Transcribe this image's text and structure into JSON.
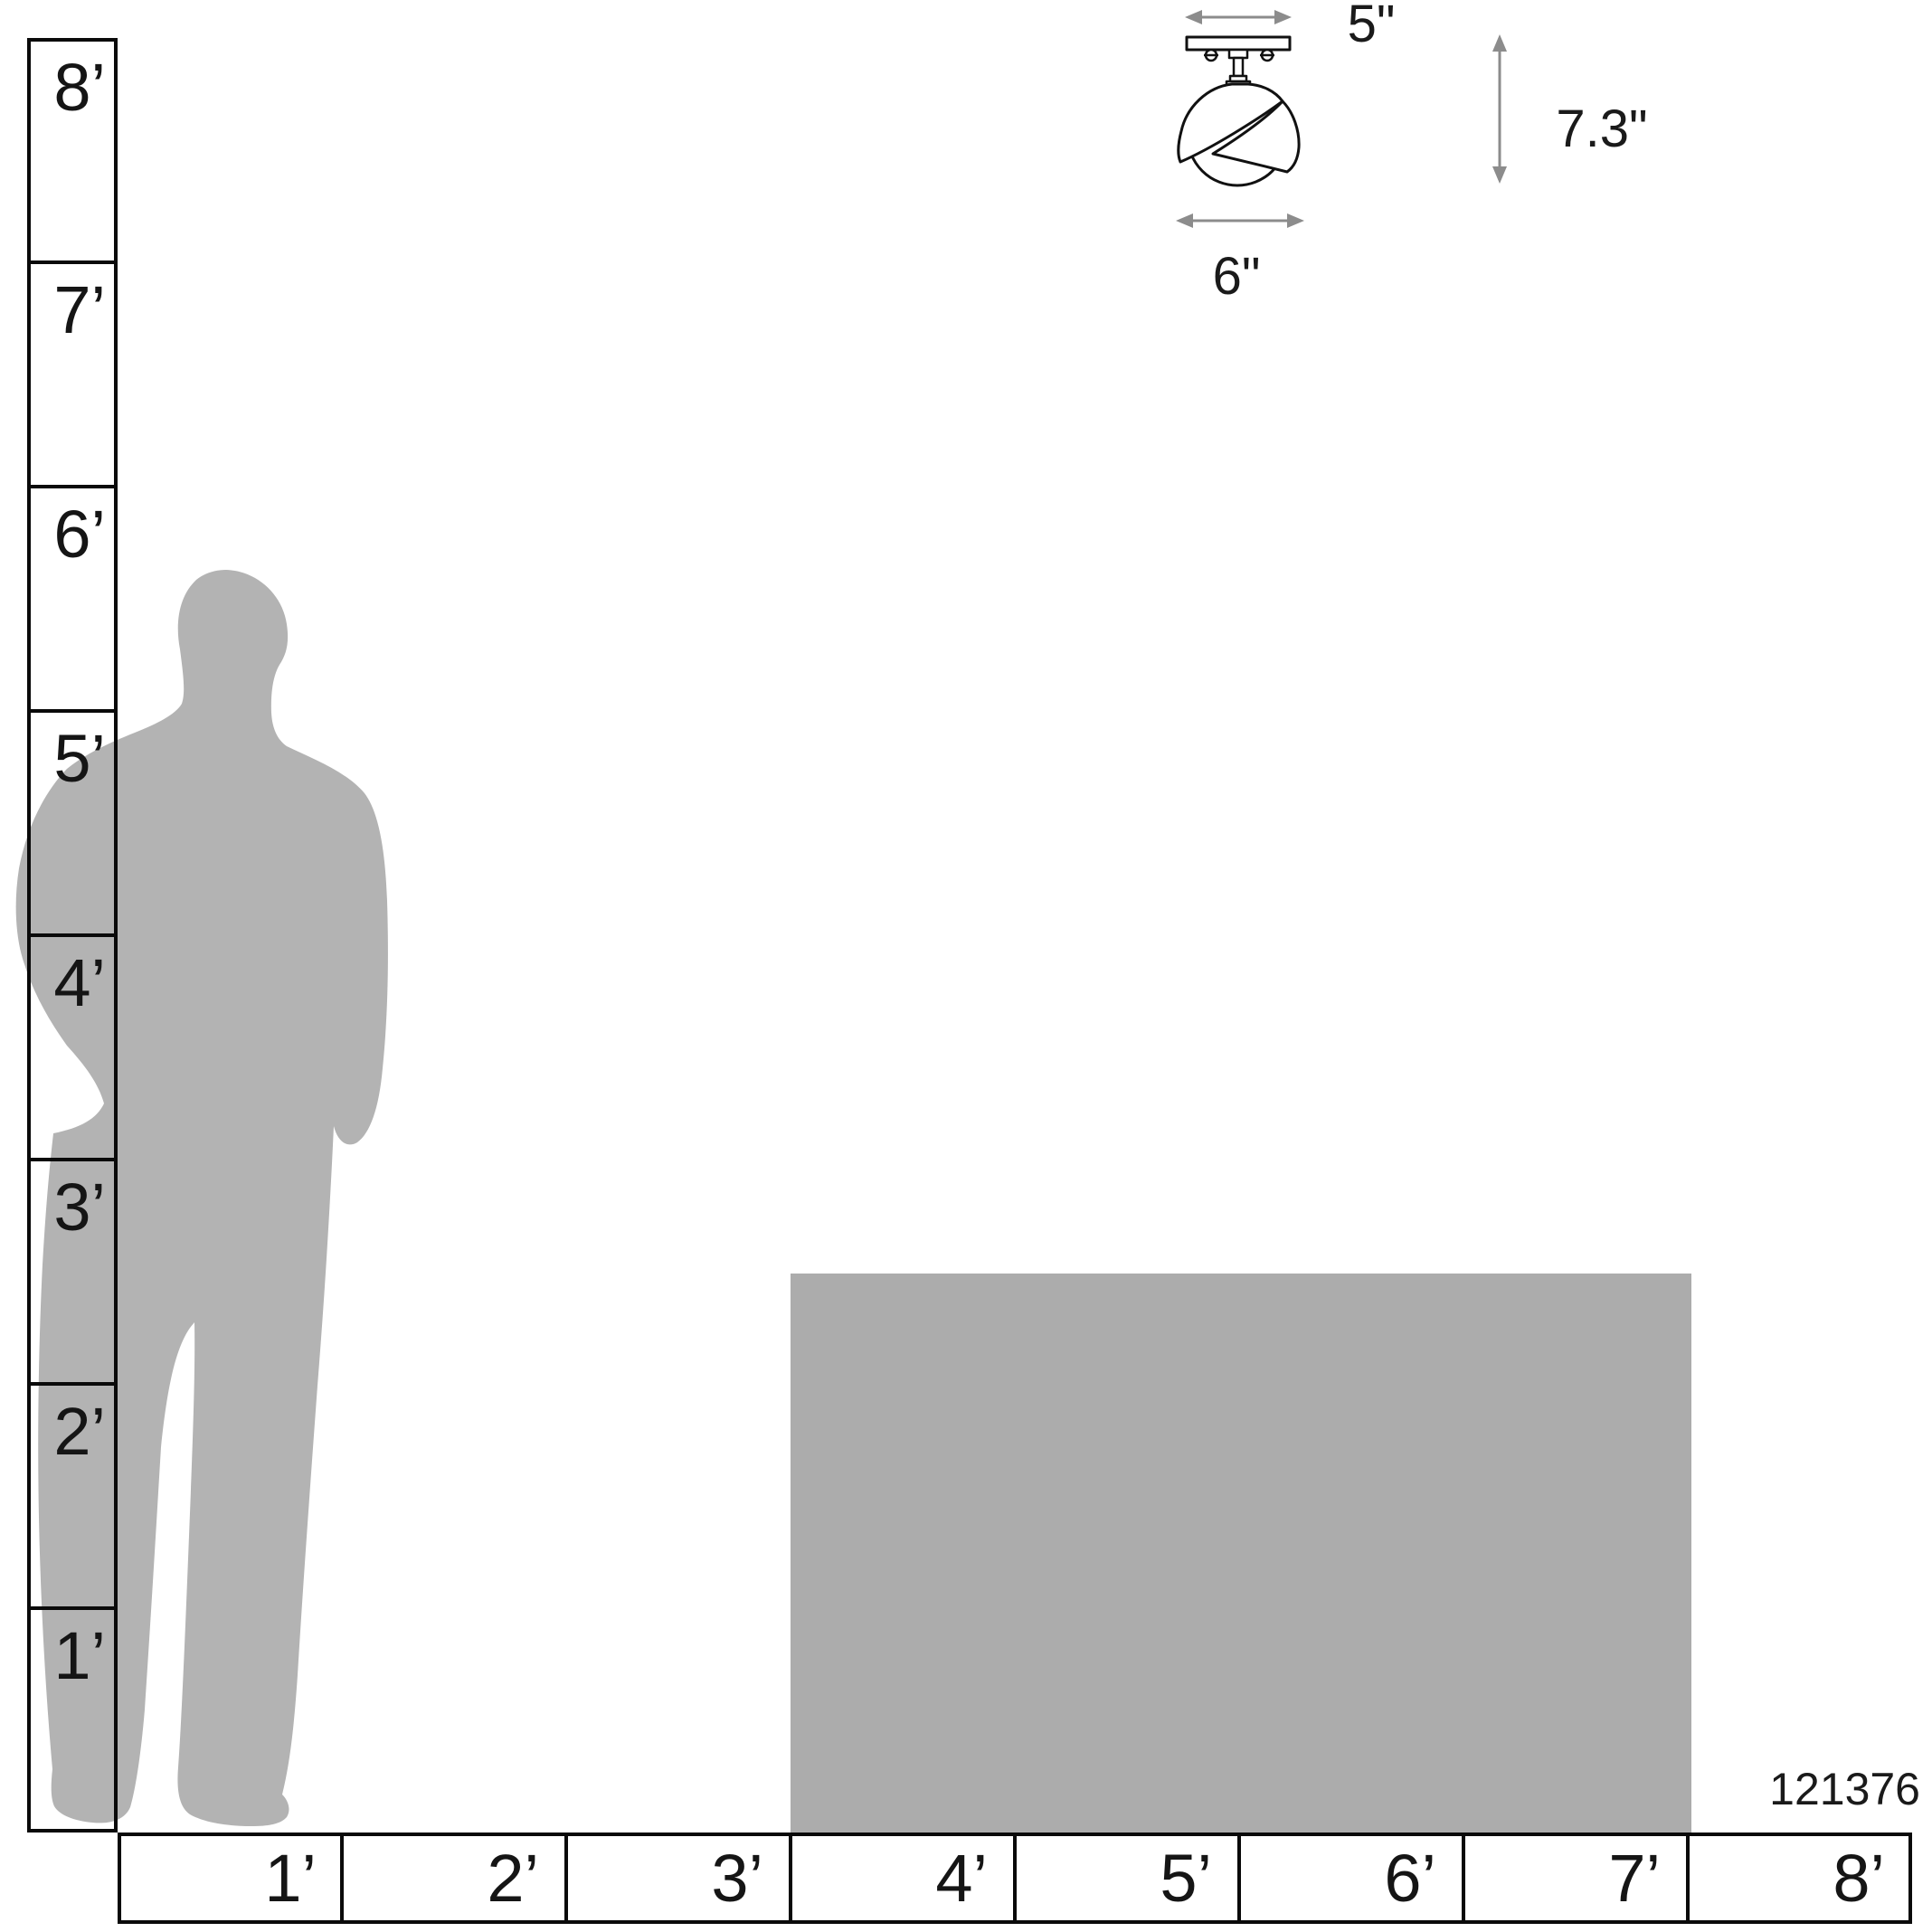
{
  "diagram": {
    "kind": "product-scale-diagram",
    "product_code": "121376"
  },
  "fixture": {
    "canopy_width": "5\"",
    "fixture_height": "7.3\"",
    "shade_width": "6\""
  },
  "vertical_ruler_labels": [
    "8’",
    "7’",
    "6’",
    "5’",
    "4’",
    "3’",
    "2’",
    "1’"
  ],
  "horizontal_ruler_labels": [
    "1’",
    "2’",
    "3’",
    "4’",
    "5’",
    "6’",
    "7’",
    "8’"
  ],
  "colors": {
    "figure": "#b3b3b3",
    "table": "#acacac",
    "line": "#111111",
    "arrow": "#8c8c8c",
    "text": "#1a1a1a"
  }
}
